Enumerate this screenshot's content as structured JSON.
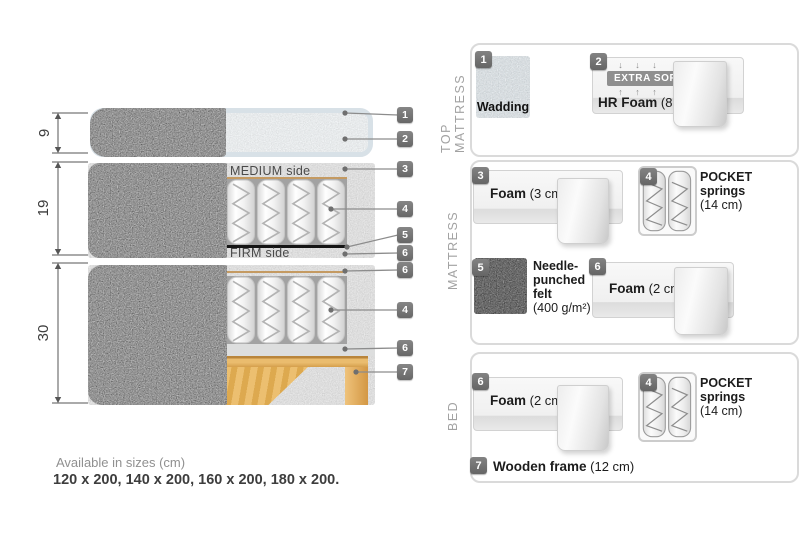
{
  "diagram": {
    "dimensions": [
      {
        "label": "9"
      },
      {
        "label": "19"
      },
      {
        "label": "30"
      }
    ],
    "medium_side_label": "MEDIUM side",
    "firm_side_label": "FIRM side",
    "callouts": [
      {
        "num": "1"
      },
      {
        "num": "2"
      },
      {
        "num": "3"
      },
      {
        "num": "4"
      },
      {
        "num": "5"
      },
      {
        "num": "6"
      },
      {
        "num": "6"
      },
      {
        "num": "4"
      },
      {
        "num": "6"
      },
      {
        "num": "7"
      }
    ]
  },
  "legend": {
    "top_mattress": {
      "title": "TOP MATTRESS",
      "wadding": {
        "num": "1",
        "label": "Wadding"
      },
      "hr_foam": {
        "num": "2",
        "arrows_down": "↓ ↓ ↓",
        "soft_badge": "EXTRA SOFT",
        "arrows_up": "↑ ↑ ↑",
        "name": "HR Foam",
        "size": "(8 cm)"
      }
    },
    "mattress": {
      "title": "MATTRESS",
      "foam3": {
        "num": "3",
        "name": "Foam",
        "size": "(3 cm)"
      },
      "pocket": {
        "num": "4",
        "name": "POCKET\nsprings",
        "size": "(14 cm)"
      },
      "felt": {
        "num": "5",
        "name": "Needle-\npunched\nfelt",
        "size": "(400 g/m²)"
      },
      "foam2": {
        "num": "6",
        "name": "Foam",
        "size": "(2 cm)"
      }
    },
    "bed": {
      "title": "BED",
      "foam2": {
        "num": "6",
        "name": "Foam",
        "size": "(2 cm)"
      },
      "pocket": {
        "num": "4",
        "name": "POCKET\nsprings",
        "size": "(14 cm)"
      },
      "frame": {
        "num": "7",
        "name": "Wooden frame",
        "size": "(12 cm)"
      }
    }
  },
  "footer": {
    "sizes_title": "Available in sizes (cm)",
    "sizes_values": "120 x 200, 140 x 200, 160 x 200, 180 x 200."
  },
  "colors": {
    "fabric_gray": "#a9a9a9",
    "wadding_blue": "#dde5ea",
    "wood_tan": "#e0a854",
    "badge_gray": "#6f6f6f",
    "panel_border": "#dadada",
    "felt_black_line": "#151515"
  }
}
